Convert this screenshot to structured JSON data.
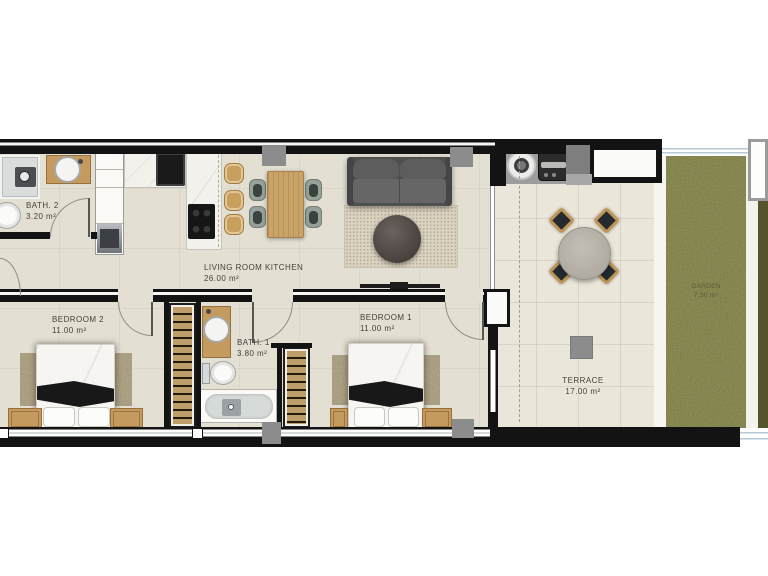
{
  "plan": {
    "rooms": [
      {
        "id": "bath2",
        "name": "BATH. 2",
        "area": "3.20 m²"
      },
      {
        "id": "living",
        "name": "LIVING ROOM KITCHEN",
        "area": "26.00 m²"
      },
      {
        "id": "bedroom2",
        "name": "BEDROOM 2",
        "area": "11.00 m²"
      },
      {
        "id": "bath1",
        "name": "BATH. 1",
        "area": "3.80 m²"
      },
      {
        "id": "bedroom1",
        "name": "BEDROOM 1",
        "area": "11.00 m²"
      },
      {
        "id": "terrace",
        "name": "TERRACE",
        "area": "17.00 m²"
      },
      {
        "id": "garden",
        "name": "GARDEN",
        "area": "7.50 m²"
      }
    ],
    "colors": {
      "wall": "#131313",
      "floor": "#e3dfd3",
      "terrace_floor": "#eae6da",
      "garden_green": "#90905a",
      "garden_dark": "#57562f",
      "wood": "#c49a5f",
      "sofa_gray": "#585858",
      "pillar_gray": "#8c8c8c",
      "label_text": "#45413a"
    }
  }
}
